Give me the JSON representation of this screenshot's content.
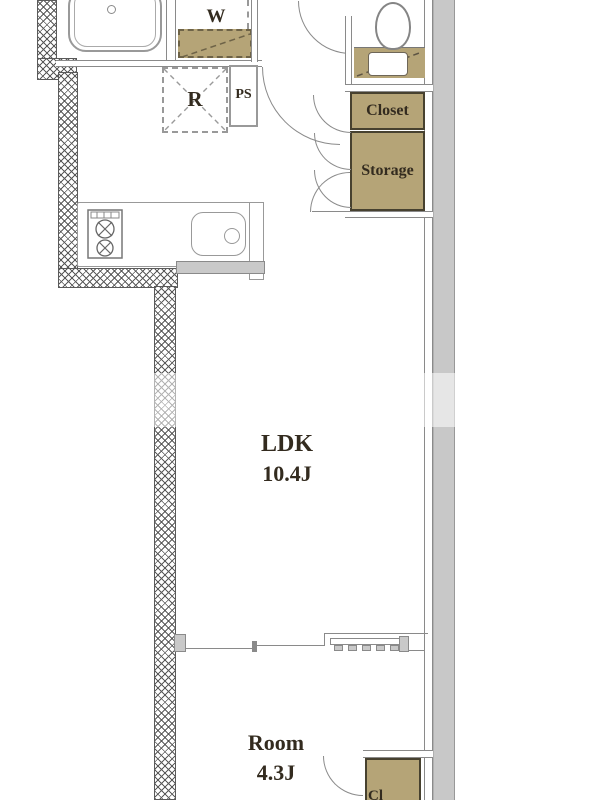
{
  "plan": {
    "labels": {
      "washer": "W",
      "fridge": "R",
      "pipe_space": "PS",
      "closet": "Closet",
      "storage": "Storage",
      "ldk_name": "LDK",
      "ldk_size": "10.4J",
      "room_name": "Room",
      "room_size": "4.3J",
      "bottom_closet": "Cl"
    },
    "colors": {
      "fixture_tan": "#b5a477",
      "tan_border": "#47412f",
      "wall_gray": "#8a8a8a",
      "outer_wall_fill": "#c8c8c8",
      "hatch_line": "#5a5a5a",
      "label_text": "#332b1f"
    }
  }
}
